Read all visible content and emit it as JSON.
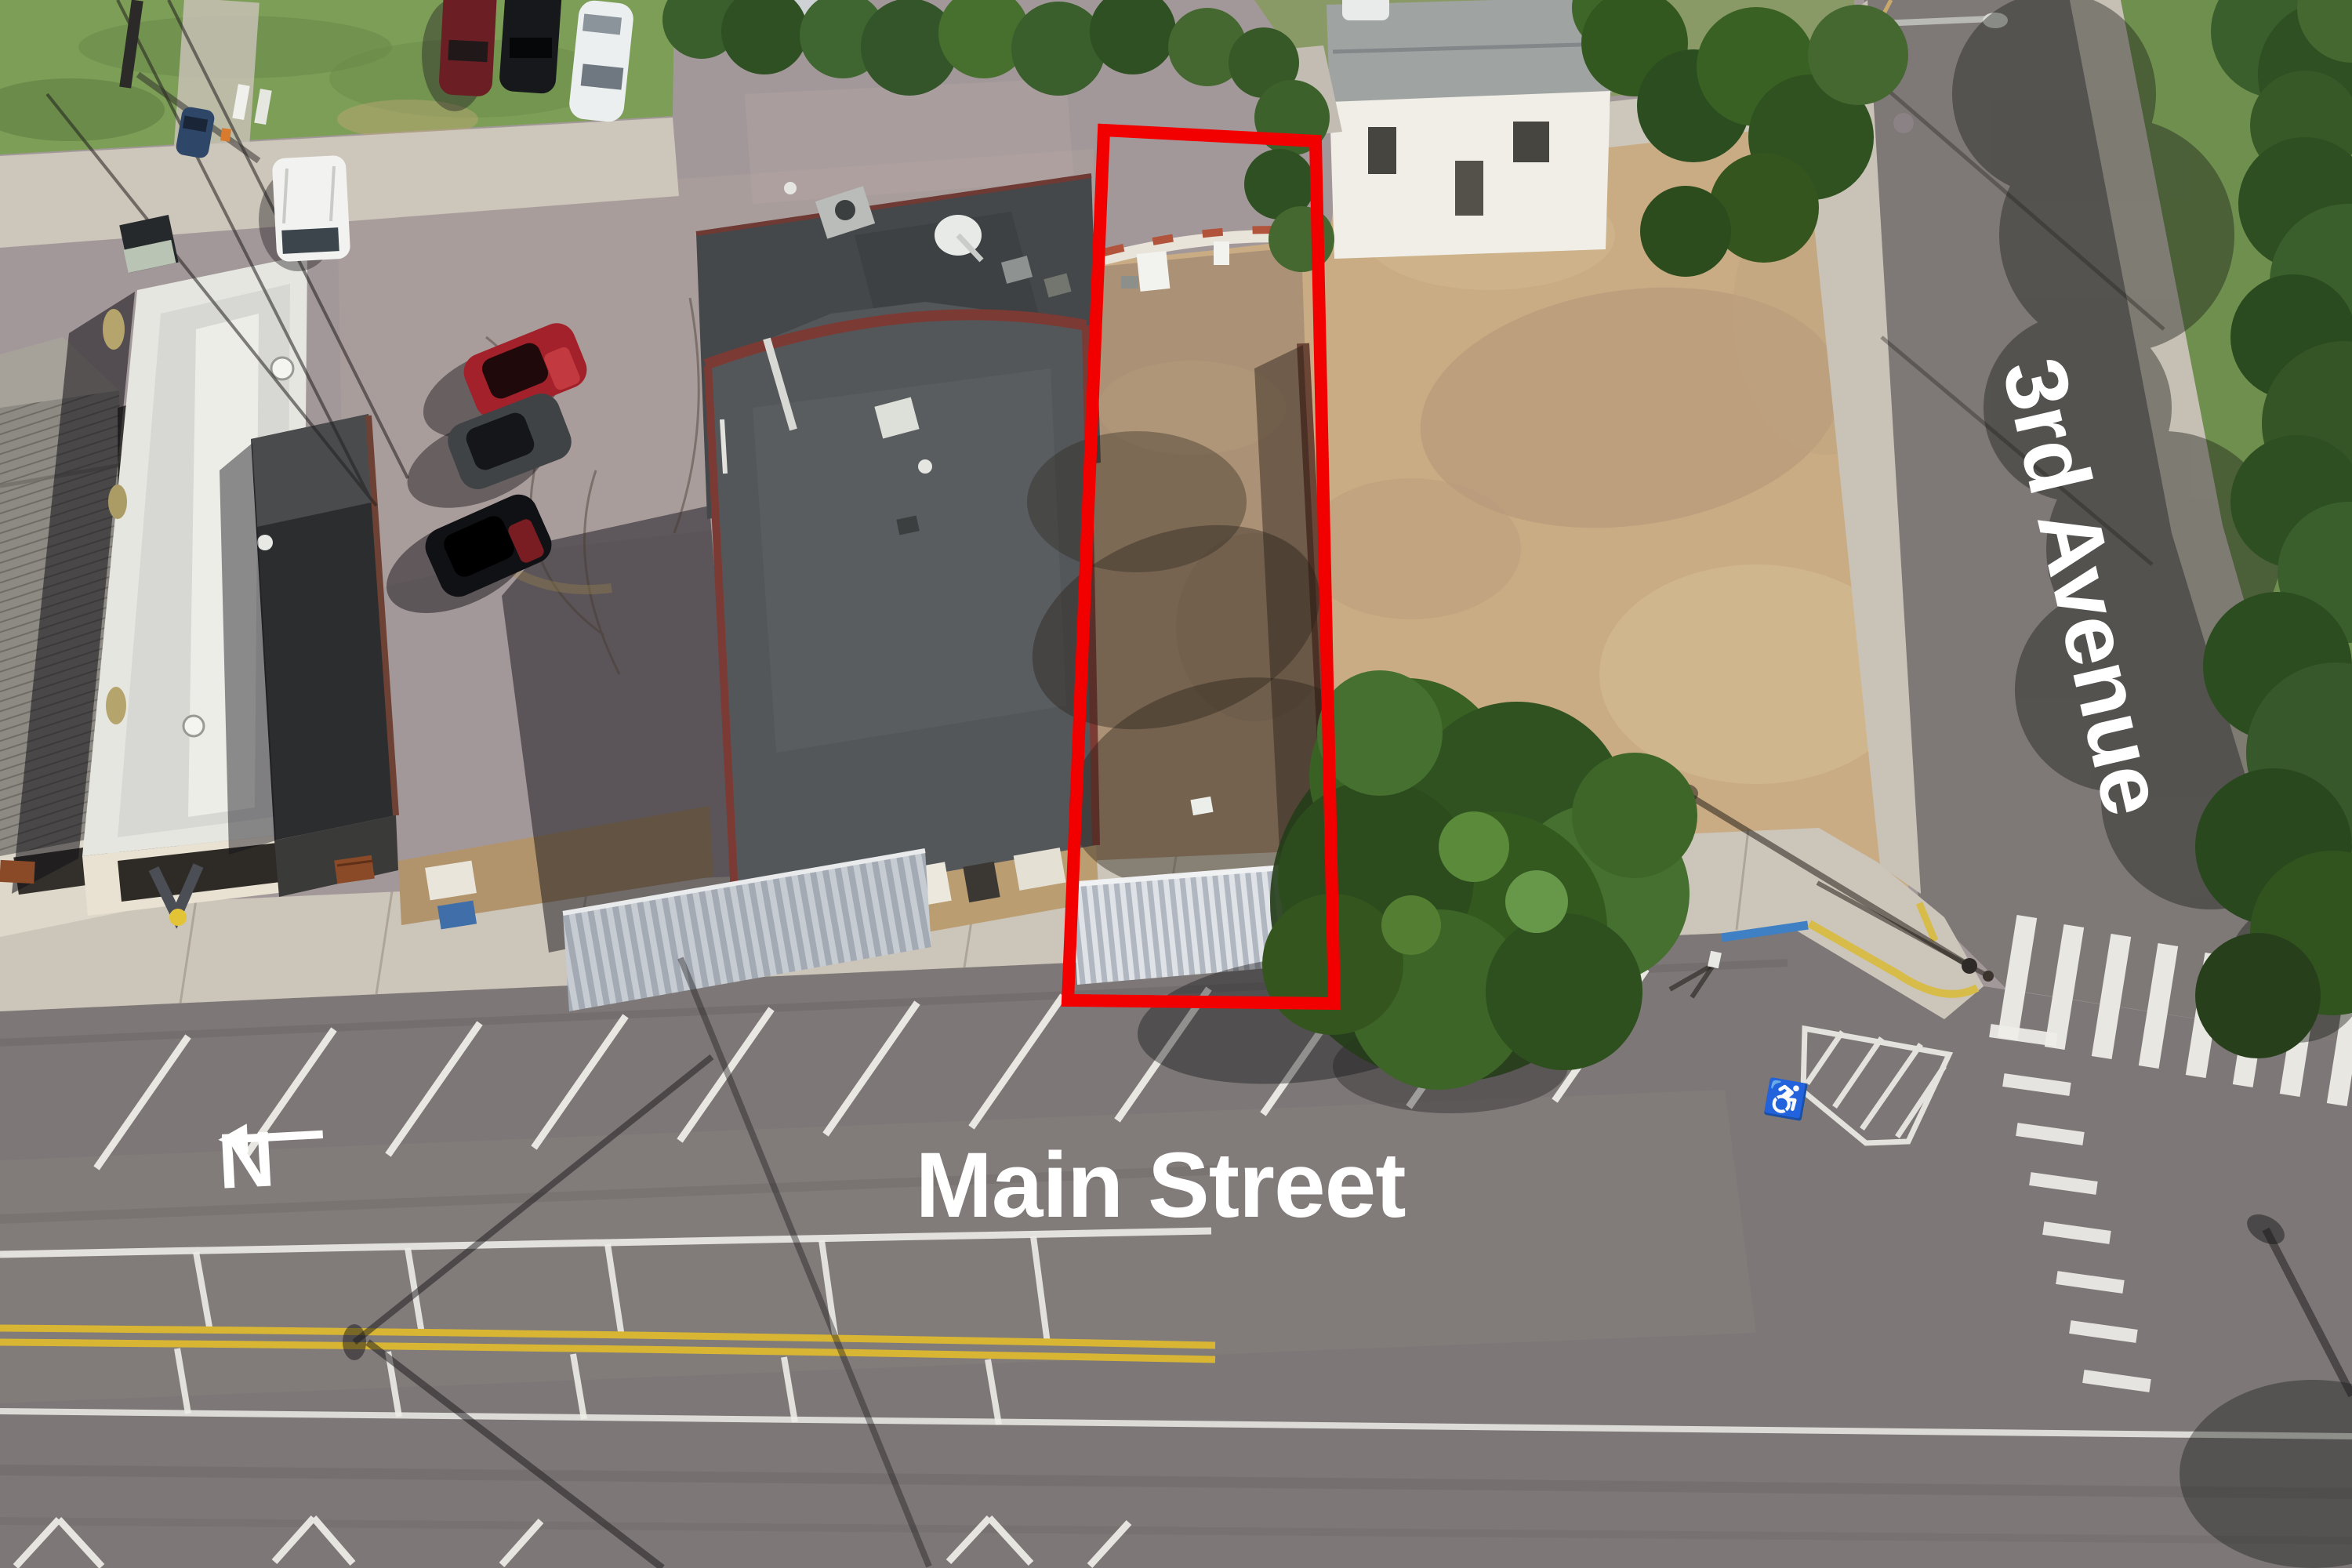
{
  "annotations": {
    "main_street_label": "Main Street",
    "cross_street_label": "3rd Avenue",
    "north_label": "N",
    "north_arrow_direction": "left",
    "boundary_color": "#f20000",
    "label_color": "#ffffff"
  }
}
